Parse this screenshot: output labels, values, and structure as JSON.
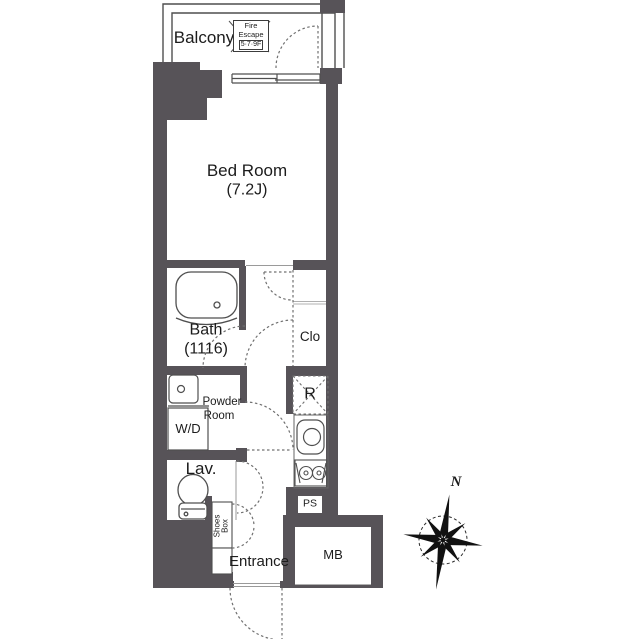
{
  "colors": {
    "wall": "#575358",
    "ink": "#1c1c1c",
    "line": "#4f4f4f",
    "light_line": "#b0b0b0",
    "dash": "#707070"
  },
  "plan": {
    "balcony": {
      "label": "Balcony"
    },
    "fire_escape": {
      "line1": "Fire",
      "line2": "Escape",
      "line3": "5·7·9F"
    },
    "bedroom": {
      "label": "Bed Room",
      "size": "(7.2J)"
    },
    "bath": {
      "label": "Bath",
      "size": "(1116)"
    },
    "closet": {
      "label": "Clo"
    },
    "powder_room": {
      "line1": "Powder",
      "line2": "Room"
    },
    "washer_dryer": {
      "label": "W/D"
    },
    "refrigerator": {
      "label": "R"
    },
    "lavatory": {
      "label": "Lav."
    },
    "shoes_box": {
      "line1": "Shoes",
      "line2": "Box"
    },
    "entrance": {
      "label": "Entrance"
    },
    "pipe_space": {
      "label": "PS"
    },
    "meter_box": {
      "label": "MB"
    },
    "compass": {
      "north": "N"
    }
  }
}
